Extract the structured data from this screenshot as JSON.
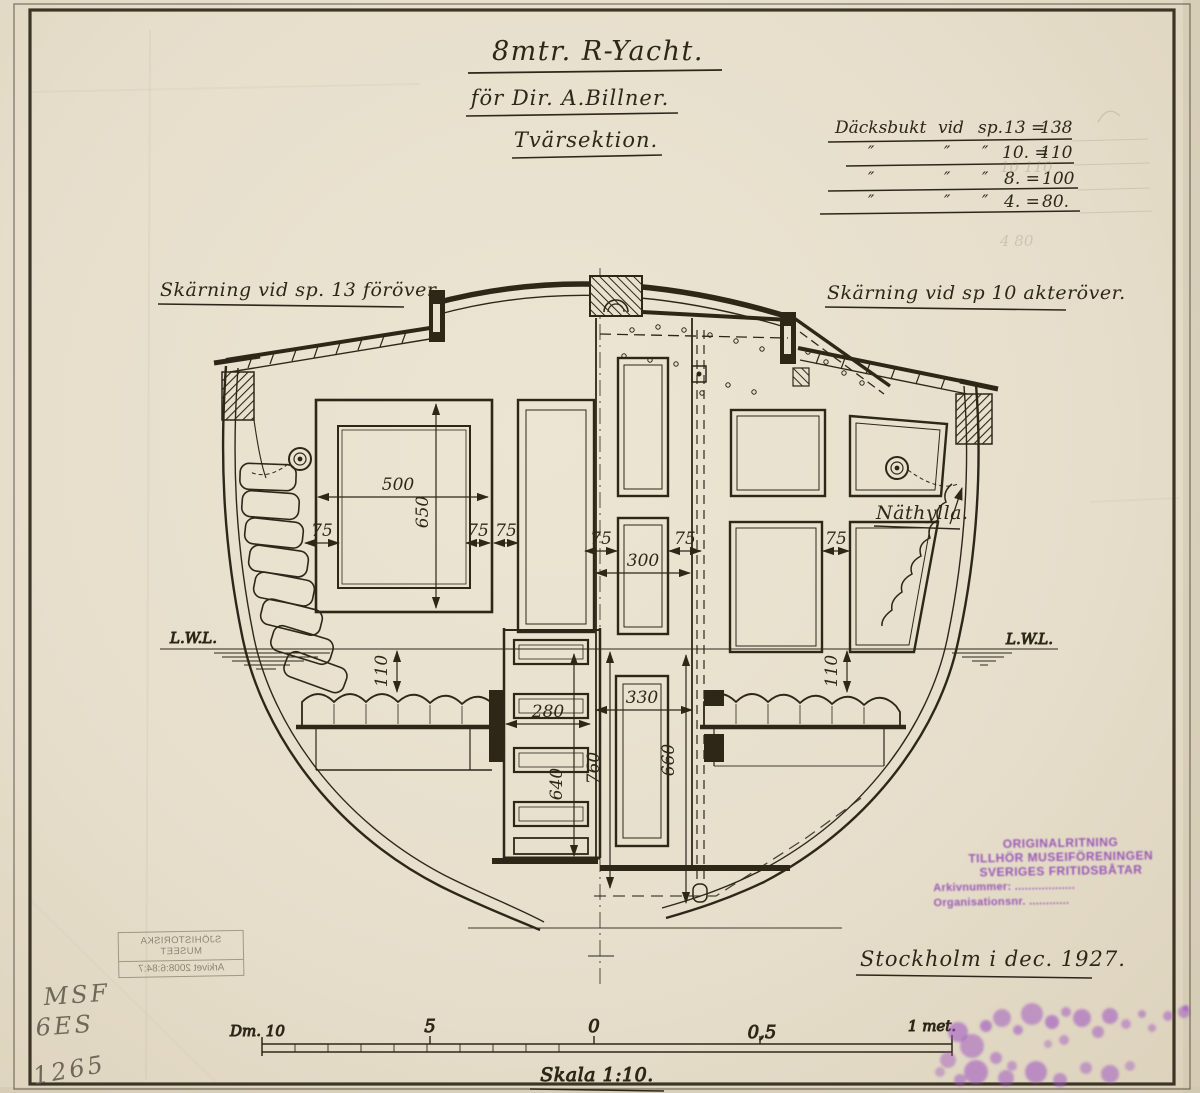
{
  "colors": {
    "paper": "#e9e1cf",
    "ink": "#2e2718",
    "stamp_purple": "#9b4fc1",
    "pencil": "#6e675a"
  },
  "title": {
    "line1": "8mtr. R-Yacht.",
    "line2": "för Dir. A.Billner.",
    "line3": "Tvärsektion."
  },
  "deck_table": {
    "rows": [
      {
        "c1": "Däcksbukt",
        "c2": "vid",
        "c3": "sp.",
        "c4": "13 =",
        "c5": "138"
      },
      {
        "c1": "″",
        "c2": "″",
        "c3": "″",
        "c4": "10. =",
        "c5": "110"
      },
      {
        "c1": "″",
        "c2": "″",
        "c3": "″",
        "c4": "8. =",
        "c5": "100"
      },
      {
        "c1": "″",
        "c2": "″",
        "c3": "″",
        "c4": "4. =",
        "c5": "80."
      }
    ]
  },
  "section_labels": {
    "left": "Skärning vid sp. 13 föröver",
    "right": "Skärning vid sp 10 akteröver."
  },
  "waterline_labels": {
    "left": "L.W.L.",
    "right": "L.W.L."
  },
  "callouts": {
    "nathylla": "Näthylla."
  },
  "dimensions": {
    "d500": "500",
    "d650": "650",
    "d75": "75",
    "d300": "300",
    "d110": "110",
    "d280": "280",
    "d330": "330",
    "d640": "640",
    "d660": "660",
    "d760": "760"
  },
  "signature": "Stockholm i dec. 1927.",
  "scale_bar": {
    "left_label": "Dm. 10",
    "tick_5": "5",
    "tick_0": "0",
    "tick_05": "0,5",
    "right_label": "1 met.",
    "caption": "Skala 1:10."
  },
  "stamps": {
    "museum_lines": [
      "ORIGINALRITNING",
      "TILLHÖR MUSEIFÖRENINGEN",
      "SVERIGES FRITIDSBÅTAR",
      "Arkivnummer: ..................",
      "Organisationsnr. ............"
    ],
    "archive_mirrored_lines": [
      "SJÖHISTORISKA MUSEET",
      "Arkivet 2008:6:84:7"
    ]
  },
  "pencil_notes": [
    "MSF",
    "6ES",
    "1265"
  ],
  "pencil_ghosts": {
    "row2": "10   110",
    "row4": "4    80"
  }
}
